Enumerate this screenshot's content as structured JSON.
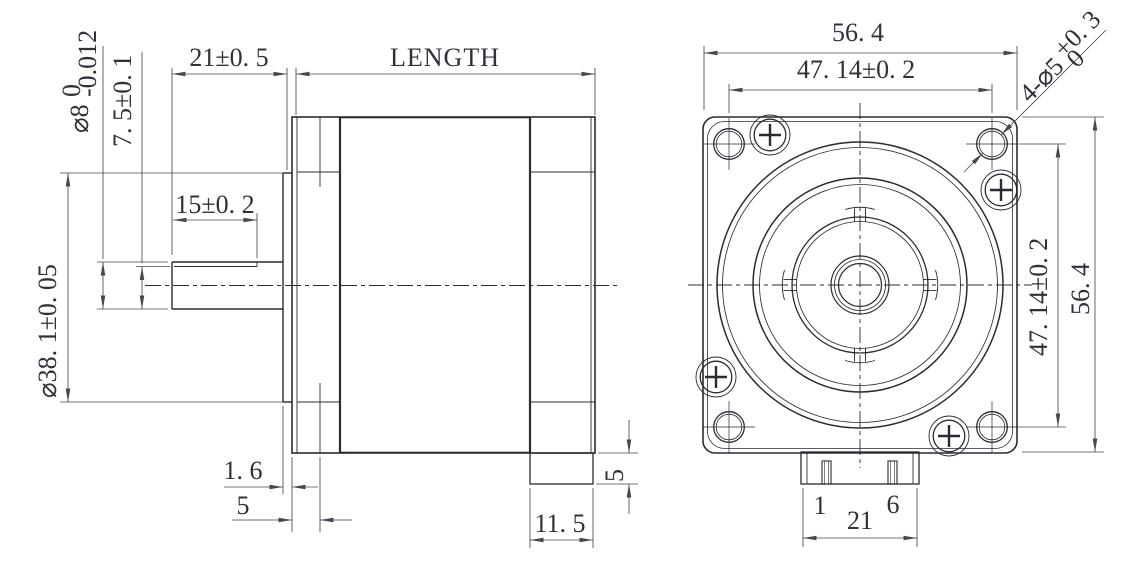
{
  "drawing_type": "stepper-motor-dimension-drawing",
  "colors": {
    "background": "#ffffff",
    "object_line": "#2a2a33",
    "dimension_line": "#474752",
    "text": "#30303b"
  },
  "side_view": {
    "shaft_diameter": {
      "base": "⌀8",
      "tol_upper": "0",
      "tol_lower": "-0.012"
    },
    "shaft_flat_height": "7. 5±0. 1",
    "shaft_length": "21±0. 5",
    "body_length": "LENGTH",
    "flat_length": "15±0. 2",
    "pilot_diameter": "⌀38. 1±0. 05",
    "pilot_depth": "1. 6",
    "front_plate_chamfer": "5",
    "connector_depth": "5",
    "rear_cap_length": "11. 5"
  },
  "front_view": {
    "flange_width": "56. 4",
    "flange_height": "56. 4",
    "hole_spacing_horizontal": "47. 14±0. 2",
    "hole_spacing_vertical": "47. 14±0. 2",
    "mounting_holes": {
      "base": "4-⌀5",
      "tol_upper": "+0. 3",
      "tol_lower": "0"
    },
    "connector": {
      "pin_first": "1",
      "pin_last": "6",
      "width": "21"
    }
  }
}
